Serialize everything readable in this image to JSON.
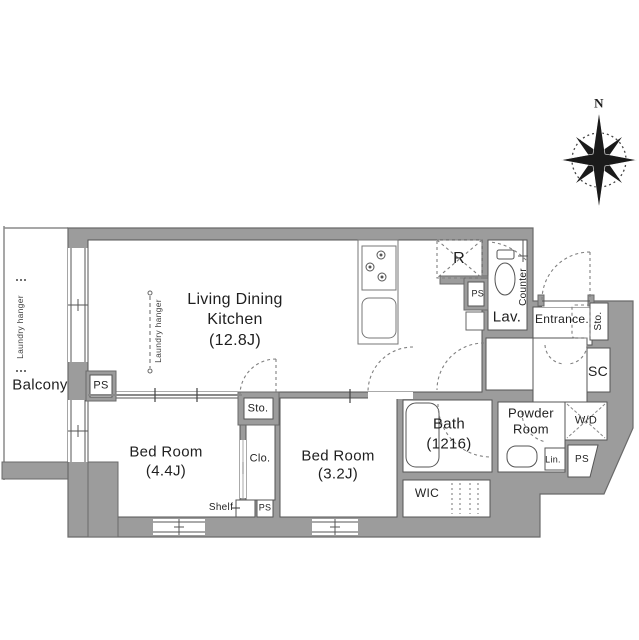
{
  "compass": {
    "north_label": "N"
  },
  "balcony": {
    "label": "Balcony",
    "laundry_hanger": "Laundry hanger"
  },
  "rooms": {
    "ldk": {
      "name_line1": "Living Dining",
      "name_line2": "Kitchen",
      "size": "(12.8J)",
      "laundry_hanger": "Laundry hanger",
      "refrigerator": "R",
      "sto": "Sto.",
      "ps": "PS"
    },
    "bedroom1": {
      "name": "Bed Room",
      "size": "(4.4J)",
      "shelf": "Shelf",
      "ps": "PS"
    },
    "bedroom2": {
      "name": "Bed Room",
      "size": "(3.2J)"
    },
    "bath": {
      "name": "Bath",
      "size": "(1216)"
    },
    "powder_room": {
      "name_line1": "Powder",
      "name_line2": "Room",
      "lin": "Lin.",
      "wd": "W/D",
      "ps": "PS"
    },
    "lav": {
      "name": "Lav.",
      "counter": "Counter"
    },
    "entrance": {
      "name": "Entrance.",
      "sto": "Sto.",
      "sc": "SC"
    },
    "wic": {
      "name": "WIC"
    },
    "clo": {
      "name": "Clo."
    }
  },
  "utilities": {
    "ps_balcony": "PS"
  },
  "colors": {
    "wall": "#9c9c9c",
    "wall_line": "#6a6a6a",
    "plan_line": "#555555",
    "text": "#1f1f1f",
    "door_dash": "#808080"
  }
}
